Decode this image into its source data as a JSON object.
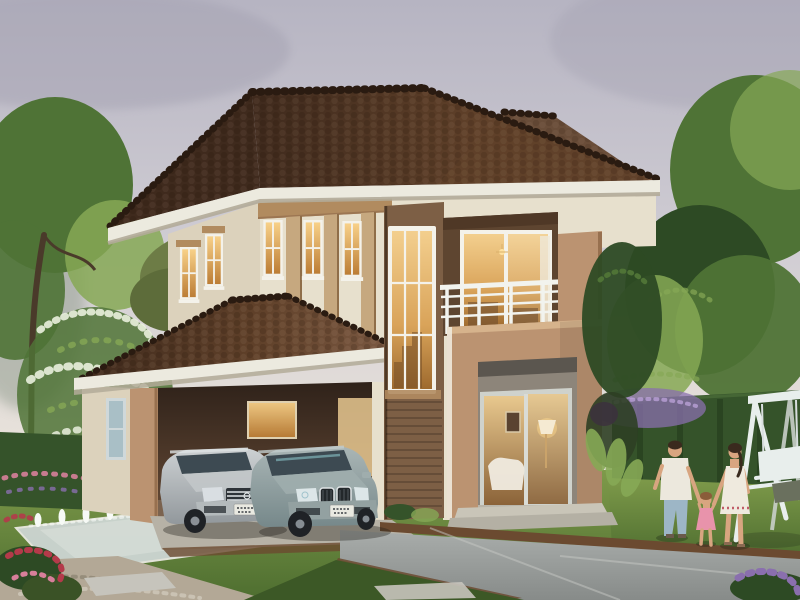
{
  "scene": {
    "type": "photorealistic architectural exterior rendering",
    "subject": "modern two-story tropical house at dusk with glowing interior lights",
    "objects": [
      "brown tiled hip roofs with ridge caps",
      "cream facade with tan beam and pilasters",
      "tall wooden stairwell panel with lit multi-pane window",
      "balcony with white railing over tan entrance block",
      "double carport with two parked sedans",
      "silver sedan",
      "gray-green sedan",
      "reflecting pool with seven fountain jets",
      "paved driveway with brown curbs",
      "lawns, hedges, blossom tree, garden trees",
      "white garden swing bench",
      "family of three holding hands (father, daughter, mother)"
    ],
    "counts": {
      "cars": 2,
      "people": 3,
      "fountain_jets": 7,
      "upper_windows": 5
    }
  },
  "colors": {
    "sky_top": "#b6b4c2",
    "sky_mid": "#cfccd3",
    "sky_low": "#e7e1da",
    "sky_horizon": "#f2ece0",
    "cloud_gray": "#a3a0b0",
    "tree_green": "#4f7336",
    "tree_light": "#86a855",
    "tree_dark": "#2d4a24",
    "trunk_brown": "#4a3a2a",
    "blossom_white": "#e9efdd",
    "hedge_green": "#35532a",
    "lawn_light": "#7e9a4a",
    "lawn_dark": "#4e6e30",
    "grass_shadow": "#3c5826",
    "roof_dark": "#3f2a1d",
    "roof_mid": "#5f4029",
    "roof_light": "#7b5942",
    "roof_ridge": "#2a1b11",
    "fascia_white": "#eceadf",
    "soffit_shadow": "#b3ab99",
    "wall_cream": "#e7e0cd",
    "wall_left_shade": "#dcd2bc",
    "beam_tan": "#b18b5f",
    "pilaster_tan": "#c6a87f",
    "accent_tan": "#bb9371",
    "accent_tan_dark": "#97704f",
    "recess_brown": "#5e4530",
    "wood_panel": "#7d5f45",
    "wood_dark": "#4f3926",
    "frame_white": "#f4f2ea",
    "railing_white": "#f2f3ee",
    "glass_amber_hi": "#f8d189",
    "glass_amber_lo": "#bc7d35",
    "car_glass": "#3d4a52",
    "porch_gray": "#8d857a",
    "pool_water": "#ccd5d1",
    "jet_white": "#f7faf6",
    "drive_light": "#a9adab",
    "drive_dark": "#878b89",
    "curb_brown": "#6b4a30",
    "gravel": "#b3a896",
    "stone_light": "#c6c4bc",
    "apron_gray": "#b7b2a6",
    "flower_red": "#b43a4a",
    "flower_pink": "#d77f9a",
    "flower_purple": "#8a6fae",
    "swing_white": "#e8eeec",
    "swing_shadow": "#c9cfc9",
    "cushion_olive": "#6a705e",
    "car_silver_hi": "#cdd1d3",
    "car_silver_lo": "#92989c",
    "car_teal_hi": "#aab6b6",
    "car_teal_lo": "#76888a",
    "chrome": "#dfe3e5",
    "plate_white": "#e9e9e1",
    "tire_black": "#1f2226",
    "skin": "#d8a580",
    "hair_dark": "#3a2a1e",
    "hair_brown": "#8a5c3a",
    "shirt_white": "#ece8dd",
    "jeans_blue": "#9db6c6",
    "dress_white": "#efeade",
    "dress_pink": "#e893ab"
  }
}
